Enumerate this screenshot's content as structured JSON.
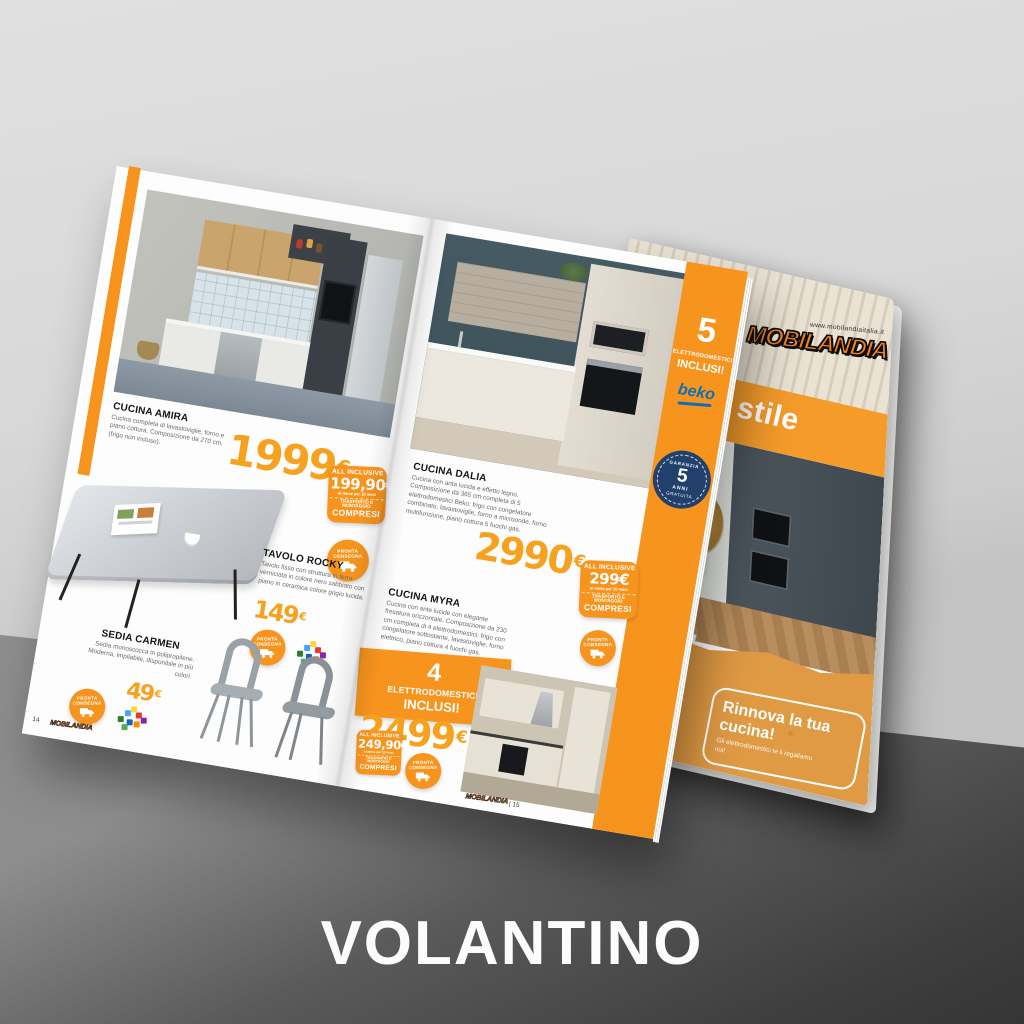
{
  "title": {
    "footer": "VOLANTINO"
  },
  "cover": {
    "url": "www.mobilandiaitalia.it",
    "logo": "MOBILANDIA",
    "tagline": "Idee di stile",
    "headline_fragment": "A!",
    "covered_fragment_top": "STICI",
    "covered_fragment_bottom": "GIO!",
    "promo_title": "Rinnova la tua cucina!",
    "promo_subtitle": "Gli elettrodomestici te li regaliamo noi!"
  },
  "sidebar": {
    "count": "5",
    "label1": "ELETTRODOMESTICI",
    "label2": "INCLUSI!",
    "brand": "beko",
    "warranty_top": "GARANZIA",
    "warranty_num": "5",
    "warranty_mid": "ANNI",
    "warranty_bottom": "GRATUITA"
  },
  "ribbon": {
    "count": "4",
    "label1": "ELETTRODOMESTICI",
    "label2": "INCLUSI!"
  },
  "products": {
    "amira": {
      "name": "CUCINA AMIRA",
      "desc": "Cucina completa di lavastoviglie, forno e piano cottura. Composizione da 270 cm. (frigo non incluso).",
      "price": "1999",
      "cur": "€"
    },
    "rocky": {
      "name": "TAVOLO ROCKY",
      "desc": "Tavolo fisso con struttura in ferro verniciata in colore nero sabbiato con piano in ceramica colore grigio lucida.",
      "price": "149",
      "cur": "€"
    },
    "carmen": {
      "name": "SEDIA CARMEN",
      "desc": "Sedia monoscocca in polipropilene. Moderna, impilabile, disponibile in più colori.",
      "price": "49",
      "cur": "€"
    },
    "dalia": {
      "name": "CUCINA DALIA",
      "desc": "Cucina con anta lucida e effetto legno. Composizione da 365 cm completa di 5 elettrodomestici Beko: frigo con congelatore combinato, lavastoviglie, forno a microonde, forno multifunzione, piano cottura 5 fuochi gas.",
      "price": "2990",
      "cur": "€"
    },
    "myra": {
      "name": "CUCINA MYRA",
      "desc": "Cucina con ante lucide con elegante fresatura orizzontale. Composizione da 230 cm completa di 4 elettrodomestici: frigo con congelatore sottostante, lavastoviglie, forno elettrico, piano cottura 4 fuochi gas.",
      "price": "2499",
      "cur": "€"
    }
  },
  "badges": {
    "allinclusive_label": "ALL INCLUSIVE",
    "terms": "al mese per 10 mesi",
    "included": "TRASPORTO E MONTAGGIO",
    "compresi": "COMPRESI",
    "amira_monthly": "199,90€",
    "dalia_monthly": "299€",
    "myra_monthly": "249,90€",
    "delivery_line1": "PRONTA",
    "delivery_line2": "CONSEGNA"
  },
  "pagination": {
    "left": "14",
    "right": "| 15",
    "brand": "MOBILANDIA"
  },
  "colors": {
    "accent": "#f7941e",
    "band": "#f49b2a",
    "sand": "#e09a44",
    "navy": "#21406b",
    "beko_blue": "#0e6fb4"
  }
}
